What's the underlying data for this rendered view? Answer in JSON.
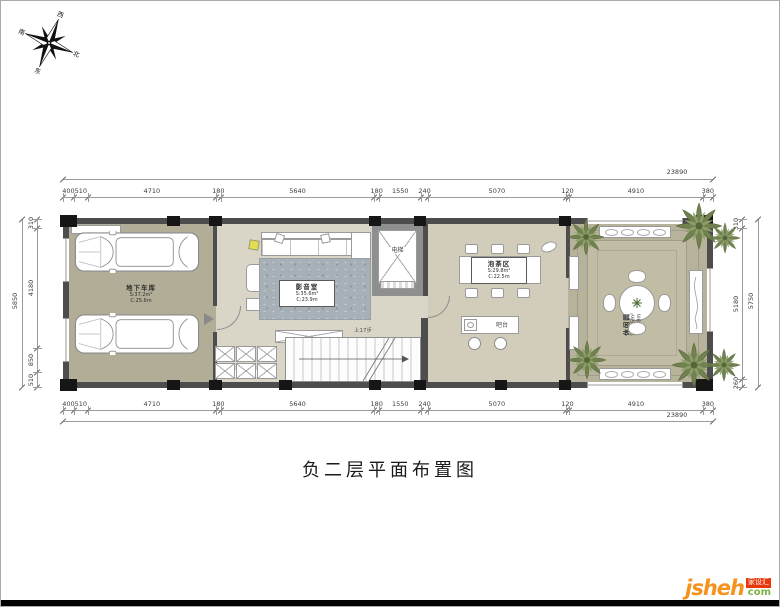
{
  "title": "负二层平面布置图",
  "compass": {
    "west": "西",
    "north": "北",
    "east": "东",
    "south": "南"
  },
  "dims": {
    "top": {
      "overall": "23890",
      "segments": [
        400,
        510,
        4710,
        180,
        5640,
        180,
        1550,
        240,
        5070,
        120,
        4910,
        380
      ]
    },
    "bottom": {
      "overall": "23890",
      "segments": [
        400,
        510,
        4710,
        180,
        5640,
        180,
        1550,
        240,
        5070,
        120,
        4910,
        380
      ]
    },
    "left": {
      "overall": "5850",
      "segments": [
        310,
        4180,
        850,
        510
      ]
    },
    "right": {
      "overall": "5750",
      "segments": [
        310,
        5180,
        260
      ]
    }
  },
  "rooms": {
    "garage": {
      "name": "地下车库",
      "area": "S:37.2m²",
      "girth": "C:25.6m"
    },
    "media": {
      "name": "影音室",
      "area": "S:35.6m²",
      "girth": "C:23.9m"
    },
    "tea": {
      "name": "泡茶区",
      "area": "S:29.8m²",
      "girth": "C:22.5m"
    },
    "garden": {
      "name": "休闲园",
      "area": "S:26.5m²",
      "girth": "C:20.8m"
    },
    "elevator": {
      "name": "电梯"
    },
    "bar": {
      "name": "吧台"
    },
    "storage": {
      "name": "储物柜"
    },
    "stairs": {
      "note": "上17步"
    }
  },
  "watermark": {
    "name": "jsheh",
    "suffix": "com",
    "badge": "家设汇"
  },
  "colors": {
    "wall": "#4d4d4d",
    "column": "#161616",
    "garage_floor": "#b2ad97",
    "media_floor": "#d9d5c7",
    "tea_floor": "#d1cdba",
    "garden_floor": "#b7b29a",
    "rug": "#a7b0b6",
    "plant": "#71824f",
    "logo_orange": "#f6921e",
    "logo_green": "#7cb342",
    "badge_red": "#e8380d"
  }
}
